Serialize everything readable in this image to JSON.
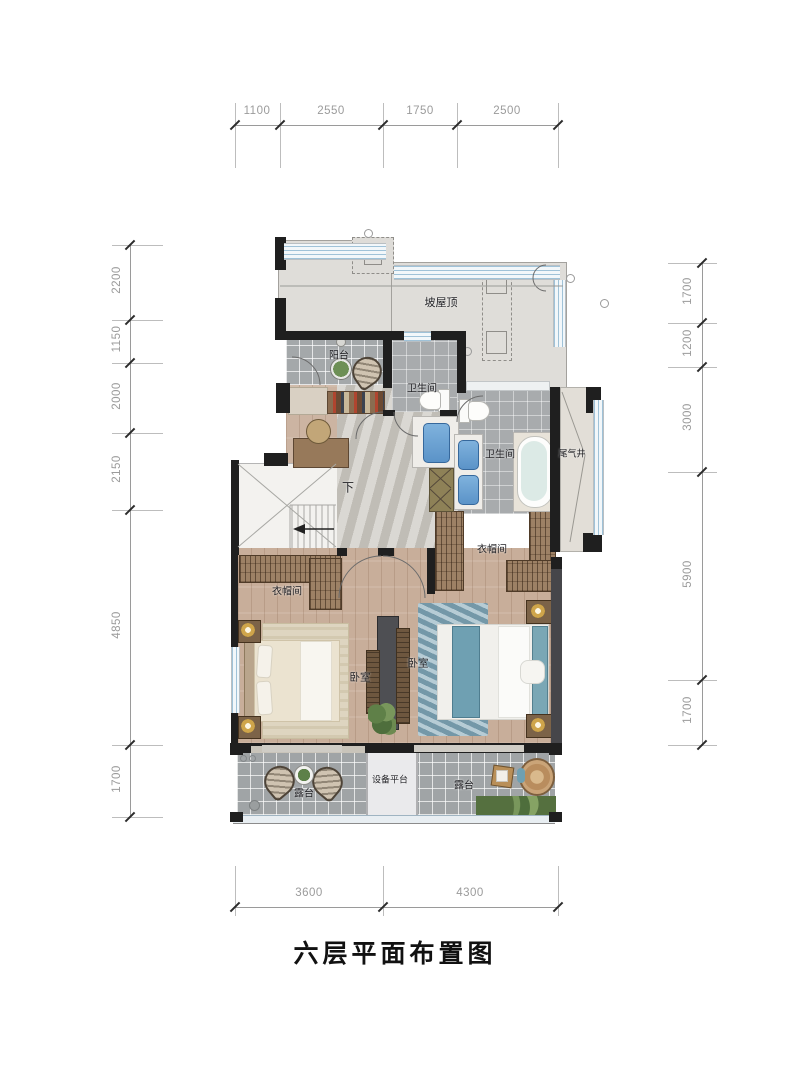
{
  "title": "六层平面布置图",
  "dimensions": {
    "top": [
      "1100",
      "2550",
      "1750",
      "2500"
    ],
    "left": [
      "2200",
      "1150",
      "2000",
      "2150",
      "4850",
      "1700"
    ],
    "right": [
      "1700",
      "1200",
      "3000",
      "5900",
      "1700"
    ],
    "bottom": [
      "3600",
      "4300"
    ]
  },
  "rooms": {
    "roof": "坡屋顶",
    "balcony": "阳台",
    "bathroom_top": "卫生间",
    "bathroom_right": "卫生间",
    "exhaust_shaft": "尾气井",
    "closet_left": "衣帽间",
    "closet_right": "衣帽间",
    "bedroom_left": "卧室",
    "bedroom_right": "卧室",
    "stairs_down": "下",
    "equipment_platform": "设备平台",
    "terrace_left": "露台",
    "terrace_right": "露台"
  },
  "colors": {
    "wall": "#1f1f1f",
    "roof_fill": "#dfddd9",
    "window_stripe": "#9fc2d8",
    "wood_floor": "#c8ae9a",
    "tile_floor": "#a4a8aa",
    "hall_floor": "#ccc9c2",
    "sink_blue": "#6aa4d8",
    "bed_teal": "#6fa0b2",
    "dimension_text": "#9b9b9b"
  }
}
